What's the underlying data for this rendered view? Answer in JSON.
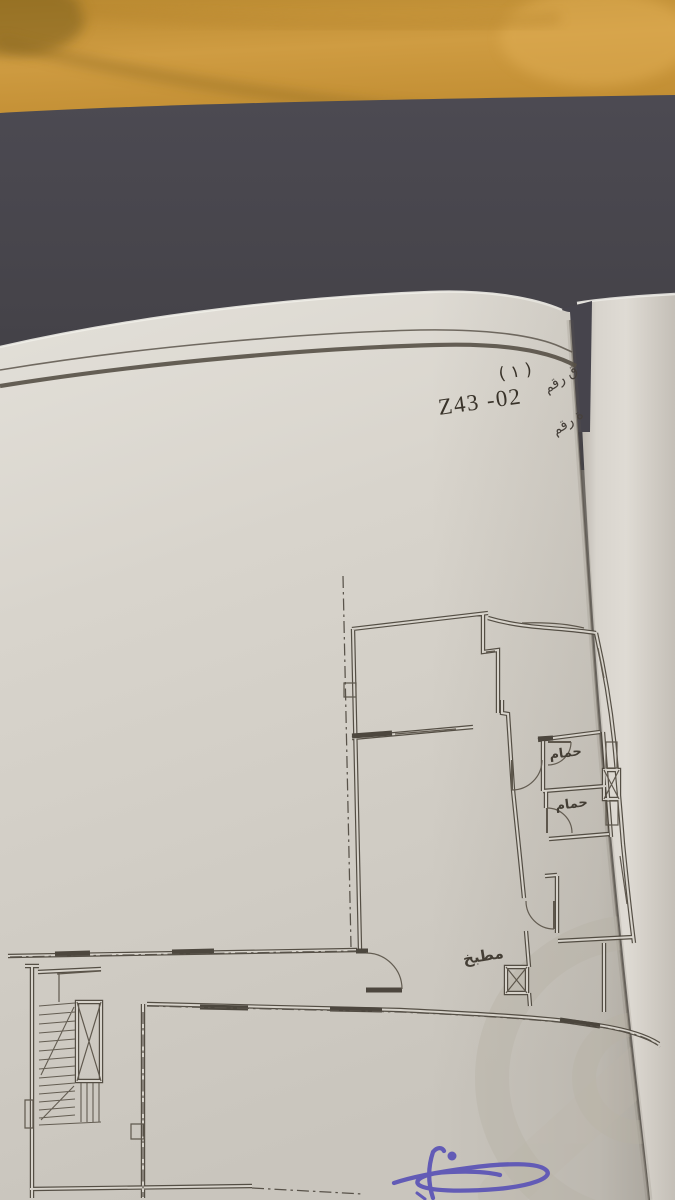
{
  "page_header": {
    "appendix_fragment": "ق رقم",
    "appendix_number": "( ١ )",
    "plate_fragment": "ة رقم",
    "plate_code": "Z43 -02"
  },
  "floor_plan": {
    "rooms": [
      {
        "label": "حمام"
      },
      {
        "label": "حمام"
      },
      {
        "label": "مطبخ"
      }
    ]
  },
  "colors": {
    "fabric_orange": "#c9953d",
    "cover_dark": "#45434b",
    "paper_light": "#dedbd4",
    "paper_shadow": "#c6c2b9",
    "plan_ink": "#4a443a",
    "signature_blue": "#5a53b6",
    "watermark_gray": "#b7b1a4"
  }
}
